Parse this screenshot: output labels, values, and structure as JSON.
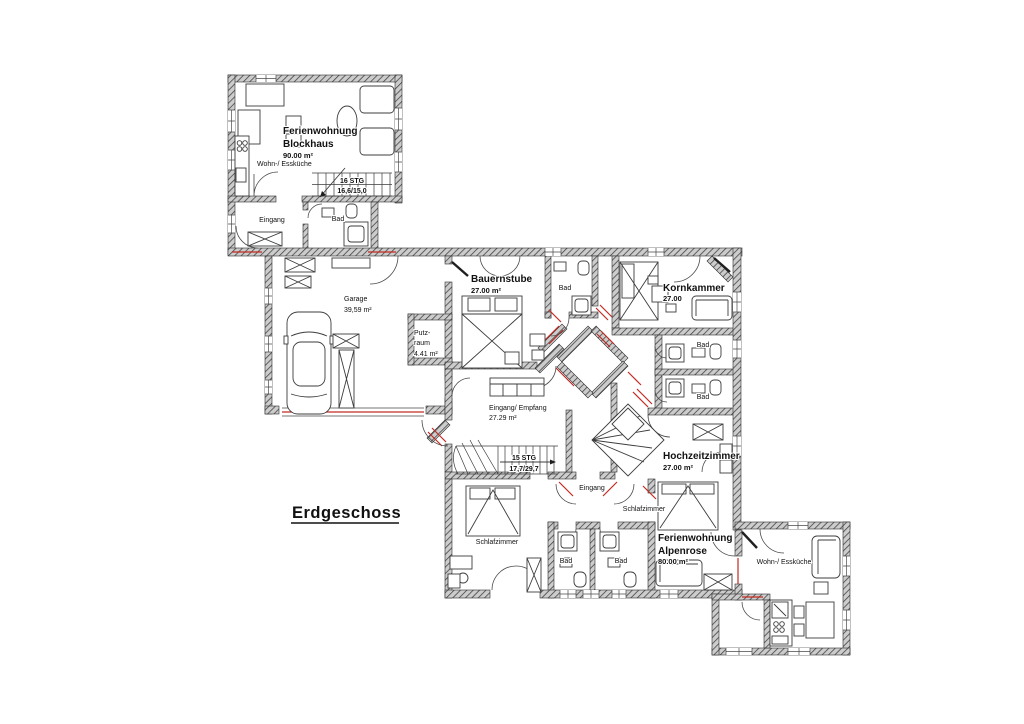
{
  "title": "Erdgeschoss",
  "colors": {
    "wall_hatch": "#3d3d3d",
    "wall_bg": "#cccccc",
    "accent_red": "#c22b22"
  },
  "labels": {
    "blockhaus": {
      "name1": "Ferienwohnung",
      "name2": "Blockhaus",
      "area": "90.00 m²",
      "kitchen": "Wohn-/ Essküche",
      "stairs_line1": "16 STG",
      "stairs_line2": "16,6/15,0",
      "entrance": "Eingang",
      "bath": "Bad"
    },
    "garage": {
      "name": "Garage",
      "area": "39,59 m²"
    },
    "putzraum": {
      "name_line1": "Putz-",
      "name_line2": "raum",
      "area": "4.41 m²"
    },
    "bauernstube": {
      "name": "Bauernstube",
      "area": "27.00 m²",
      "bath": "Bad"
    },
    "kornkammer": {
      "name": "Kornkammer",
      "area": "27.00",
      "bath_upper": "Bad",
      "bath_lower": "Bad"
    },
    "empfang": {
      "name": "Eingang/ Empfang",
      "area": "27.29 m²",
      "stairs_line1": "15 STG",
      "stairs_line2": "17,7/29,7"
    },
    "vestibule": {
      "entrance": "Eingang"
    },
    "hochzeitzimmer": {
      "name": "Hochzeitzimmer",
      "area": "27.00 m²"
    },
    "schlafzimmer_west": {
      "name": "Schlafzimmer",
      "bath_left": "Bad",
      "bath_right": "Bad"
    },
    "alpenrose": {
      "bedroom": "Schlafzimmer",
      "name1": "Ferienwohnung",
      "name2": "Alpenrose",
      "area": "80.00 m²"
    },
    "annex": {
      "kitchen": "Wohn-/ Essküche"
    }
  }
}
